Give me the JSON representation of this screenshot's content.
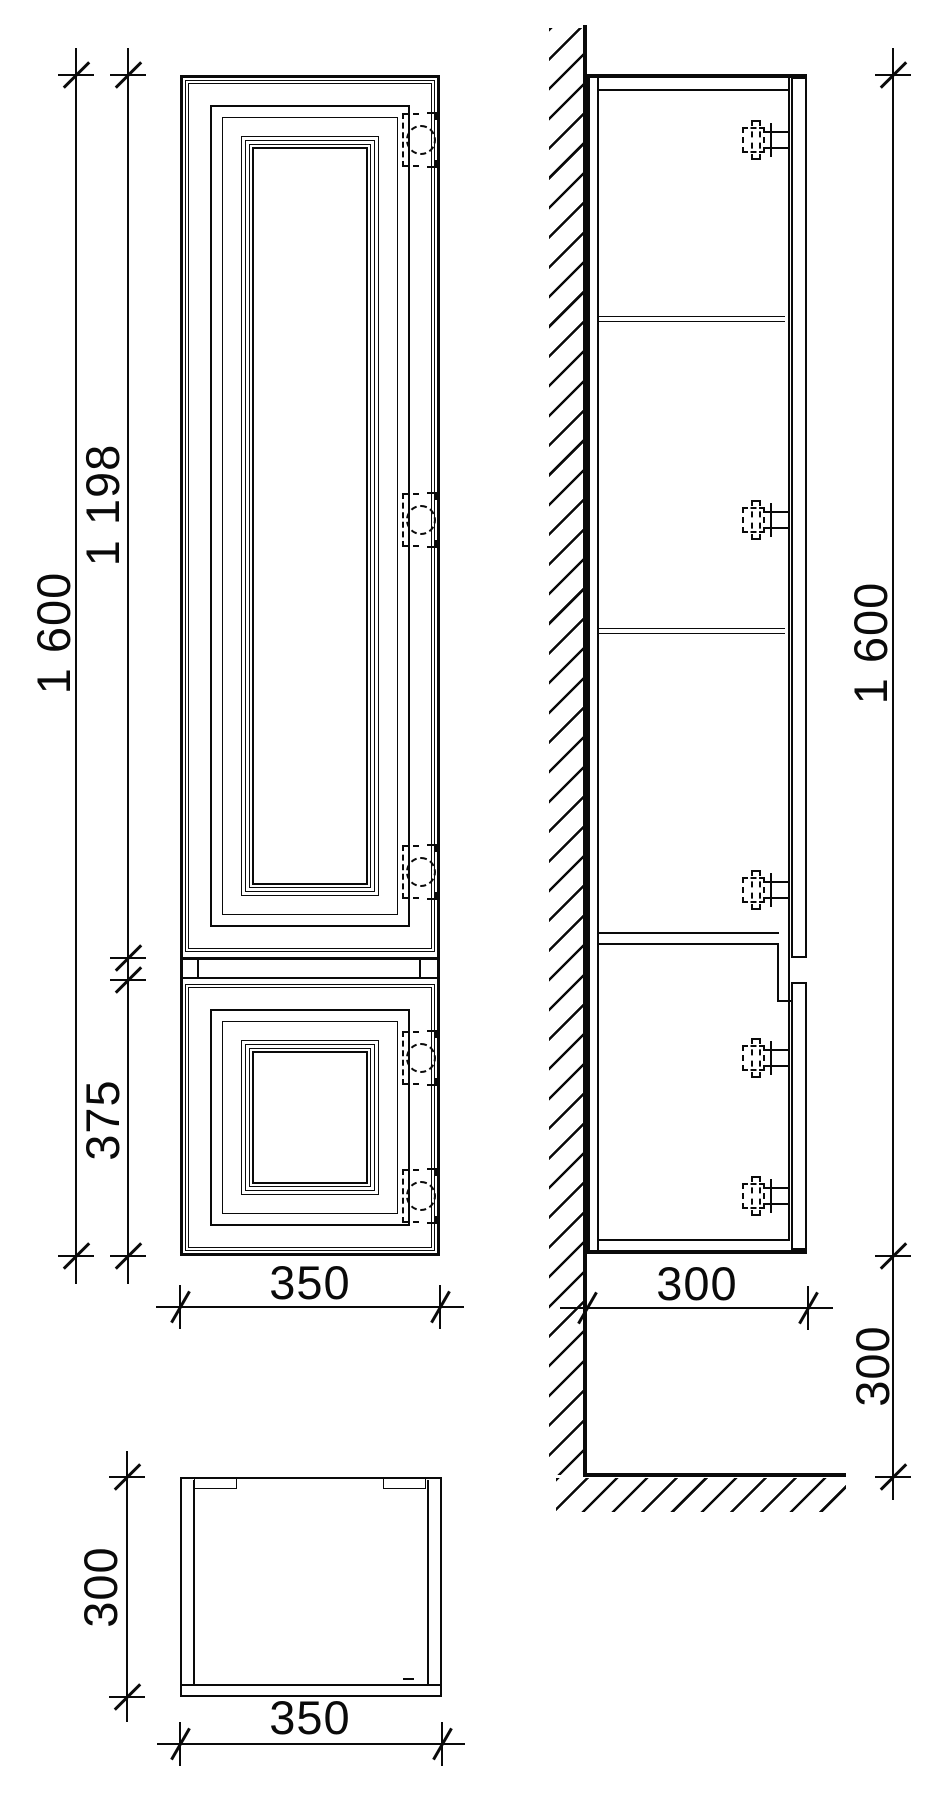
{
  "drawing": {
    "kind": "cabinet-technical-drawing",
    "views": {
      "front": {
        "name": "front elevation",
        "dims": {
          "overall_height": {
            "label": "1 600",
            "orientation": "vertical"
          },
          "upper_door_height": {
            "label": "1 198",
            "orientation": "vertical"
          },
          "lower_door_height": {
            "label": "375",
            "orientation": "vertical"
          },
          "width": {
            "label": "350",
            "orientation": "horizontal"
          }
        }
      },
      "side": {
        "name": "side section at wall",
        "dims": {
          "overall_height": {
            "label": "1 600",
            "orientation": "vertical"
          },
          "depth": {
            "label": "300",
            "orientation": "horizontal"
          },
          "floor_clearance": {
            "label": "300",
            "orientation": "vertical"
          }
        }
      },
      "plan": {
        "name": "top plan",
        "dims": {
          "depth": {
            "label": "300",
            "orientation": "vertical"
          },
          "width": {
            "label": "350",
            "orientation": "horizontal"
          }
        }
      }
    },
    "style": {
      "line_color": "#0a0a0a",
      "background": "#ffffff"
    }
  }
}
